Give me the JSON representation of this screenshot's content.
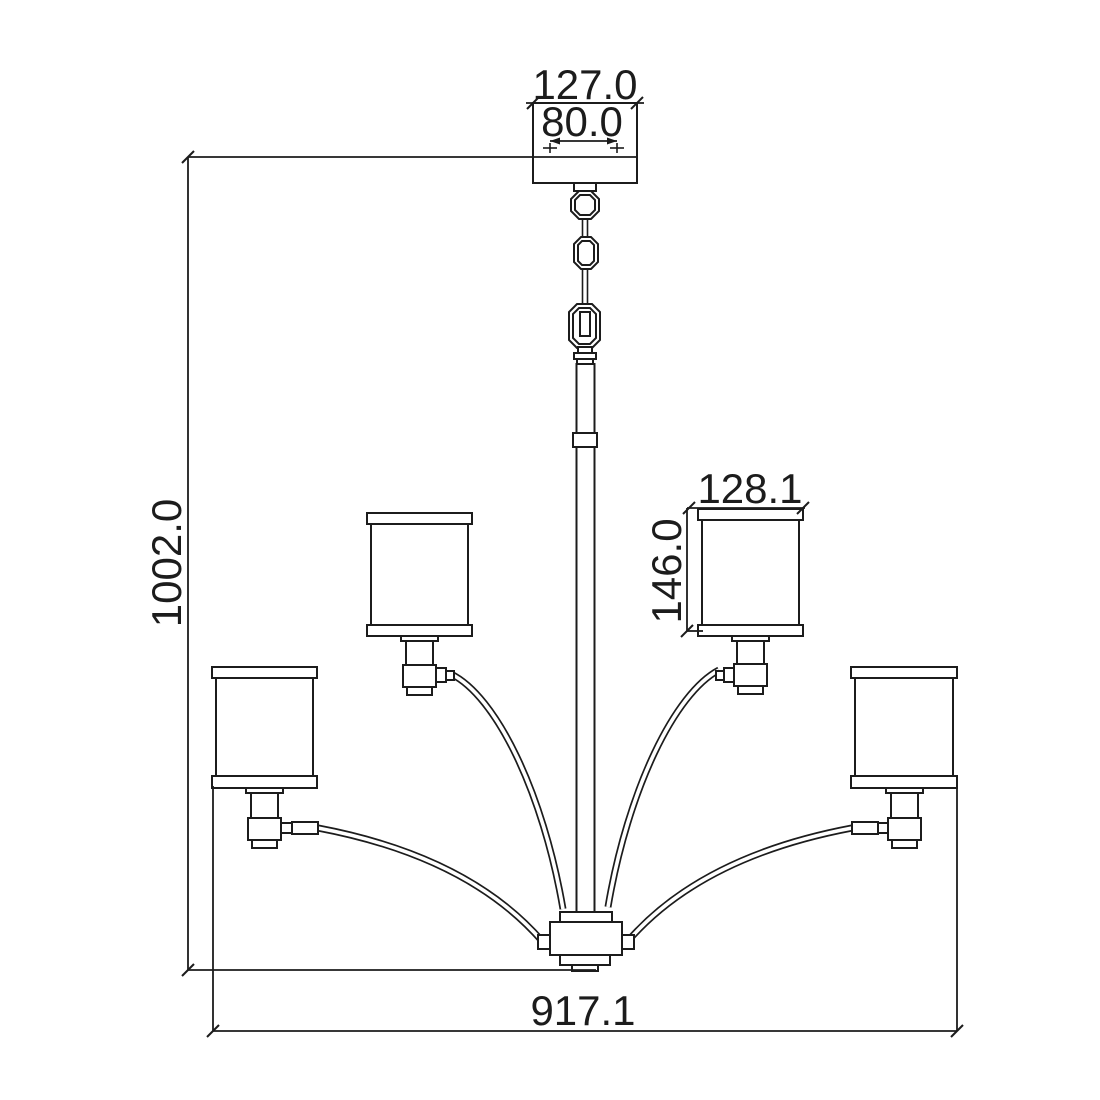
{
  "colors": {
    "ink": "#1c1c1c",
    "background": "#ffffff"
  },
  "dimensions": {
    "canopy_width": "127.0",
    "mount_hole_spacing": "80.0",
    "overall_height": "1002.0",
    "shade_width": "128.1",
    "shade_height": "146.0",
    "overall_width": "917.1"
  }
}
